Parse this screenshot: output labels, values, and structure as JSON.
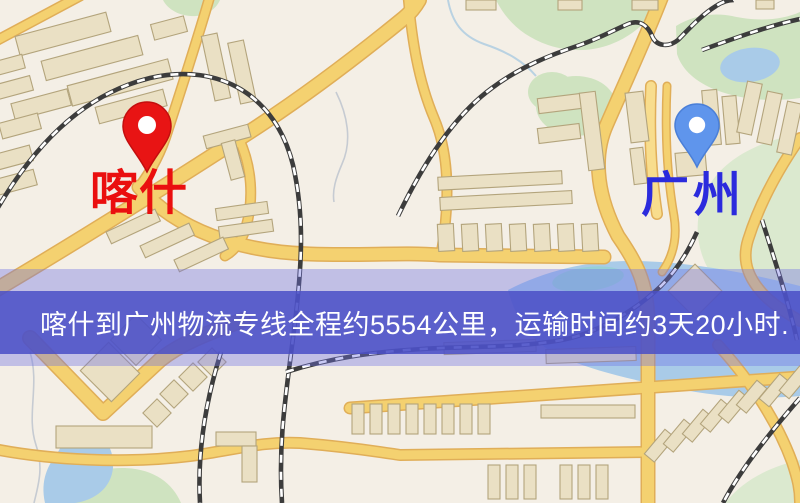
{
  "map": {
    "markers": [
      {
        "id": "origin",
        "city": "喀什",
        "pin_color": "#e81414",
        "label_color": "#ea0f0f"
      },
      {
        "id": "destination",
        "city": "广州",
        "pin_color": "#5f95ec",
        "label_color": "#2b2bdd"
      }
    ]
  },
  "banner": {
    "text": "喀什到广州物流专线全程约5554公里，运输时间约3天20小时.",
    "background_color": "#5a5ec9",
    "text_color": "#ffffff"
  },
  "map_palette": {
    "background": "#f4efe6",
    "road": "#f4d170",
    "road_casing": "#e0ae58",
    "building": "#eae0c4",
    "park": "#cfe3c0",
    "water": "#a9cbe8",
    "railway": "#3c3c3c"
  }
}
